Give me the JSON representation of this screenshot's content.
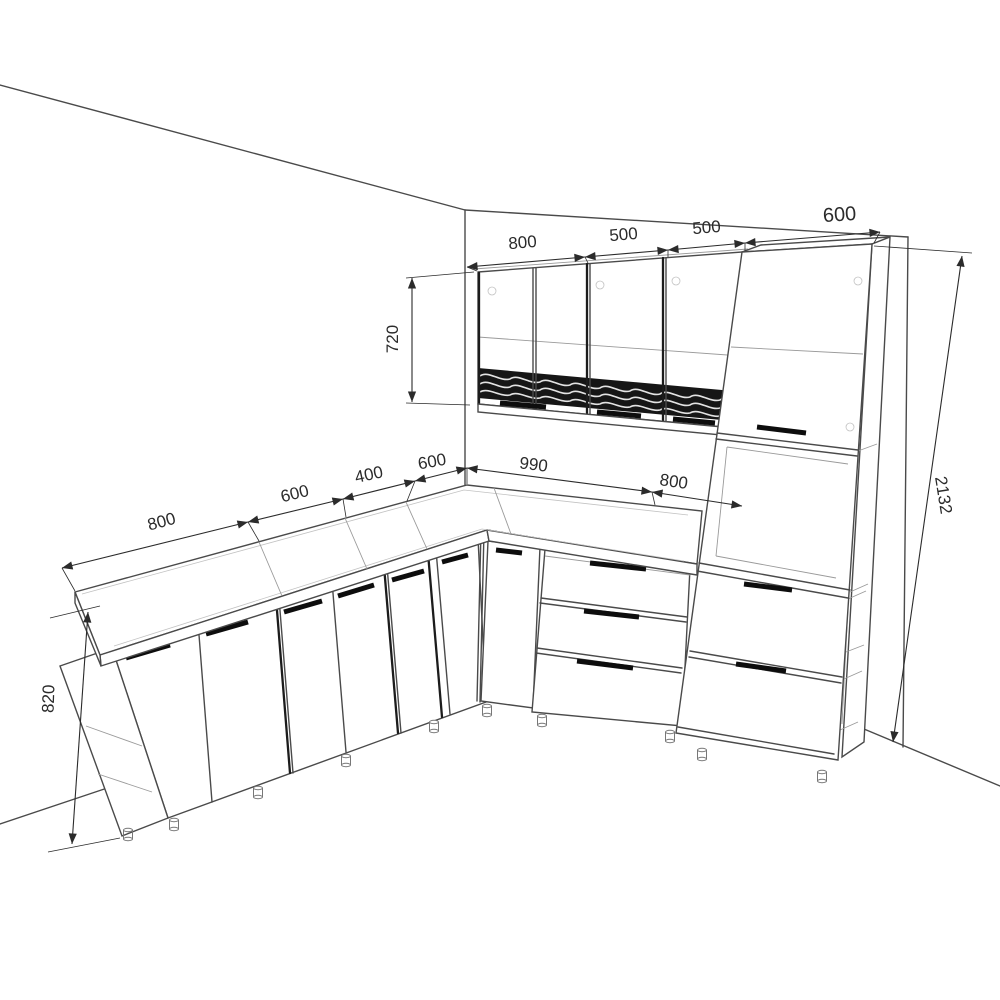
{
  "dimensions": {
    "upper_row": {
      "w1": "800",
      "w2": "500",
      "w3": "500",
      "w4": "600"
    },
    "upper_cabinet_height": "720",
    "tall_cabinet_height": "2132",
    "base_left_run": {
      "w1": "800",
      "w2": "600",
      "w3": "400",
      "w4": "600"
    },
    "base_right_run": {
      "w1": "990",
      "w2": "800"
    },
    "base_height": "820"
  }
}
